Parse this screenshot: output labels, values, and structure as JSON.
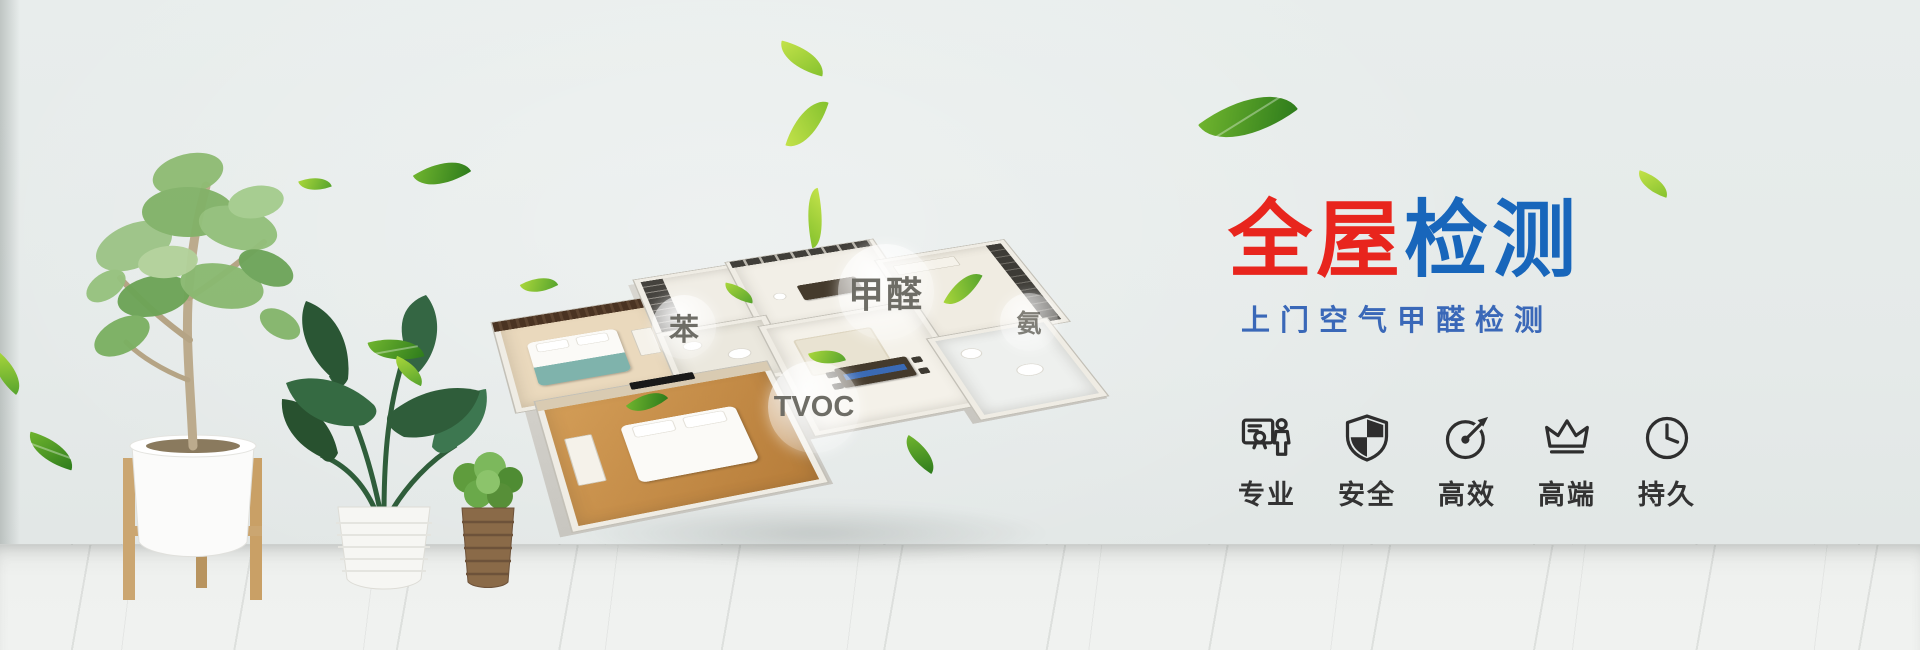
{
  "banner": {
    "headline": {
      "part1": "全屋",
      "part2": "检测"
    },
    "subtitle": "上门空气甲醛检测",
    "features": [
      {
        "label": "专业",
        "icon": "certificate-person-icon"
      },
      {
        "label": "安全",
        "icon": "shield-icon"
      },
      {
        "label": "高效",
        "icon": "gauge-icon"
      },
      {
        "label": "高端",
        "icon": "crown-icon"
      },
      {
        "label": "持久",
        "icon": "clock-icon"
      }
    ],
    "pollutants": {
      "benzene": "苯",
      "formaldehyde": "甲醛",
      "ammonia": "氨",
      "tvoc": "TVOC"
    },
    "colors": {
      "headline_red": "#e8251d",
      "headline_blue": "#1866bb",
      "subtitle_blue": "#3a68b8",
      "icon_dark": "#2e2e2e",
      "leaf_green": "#6fbf2e",
      "wall_gray": "#e5eae9"
    }
  }
}
